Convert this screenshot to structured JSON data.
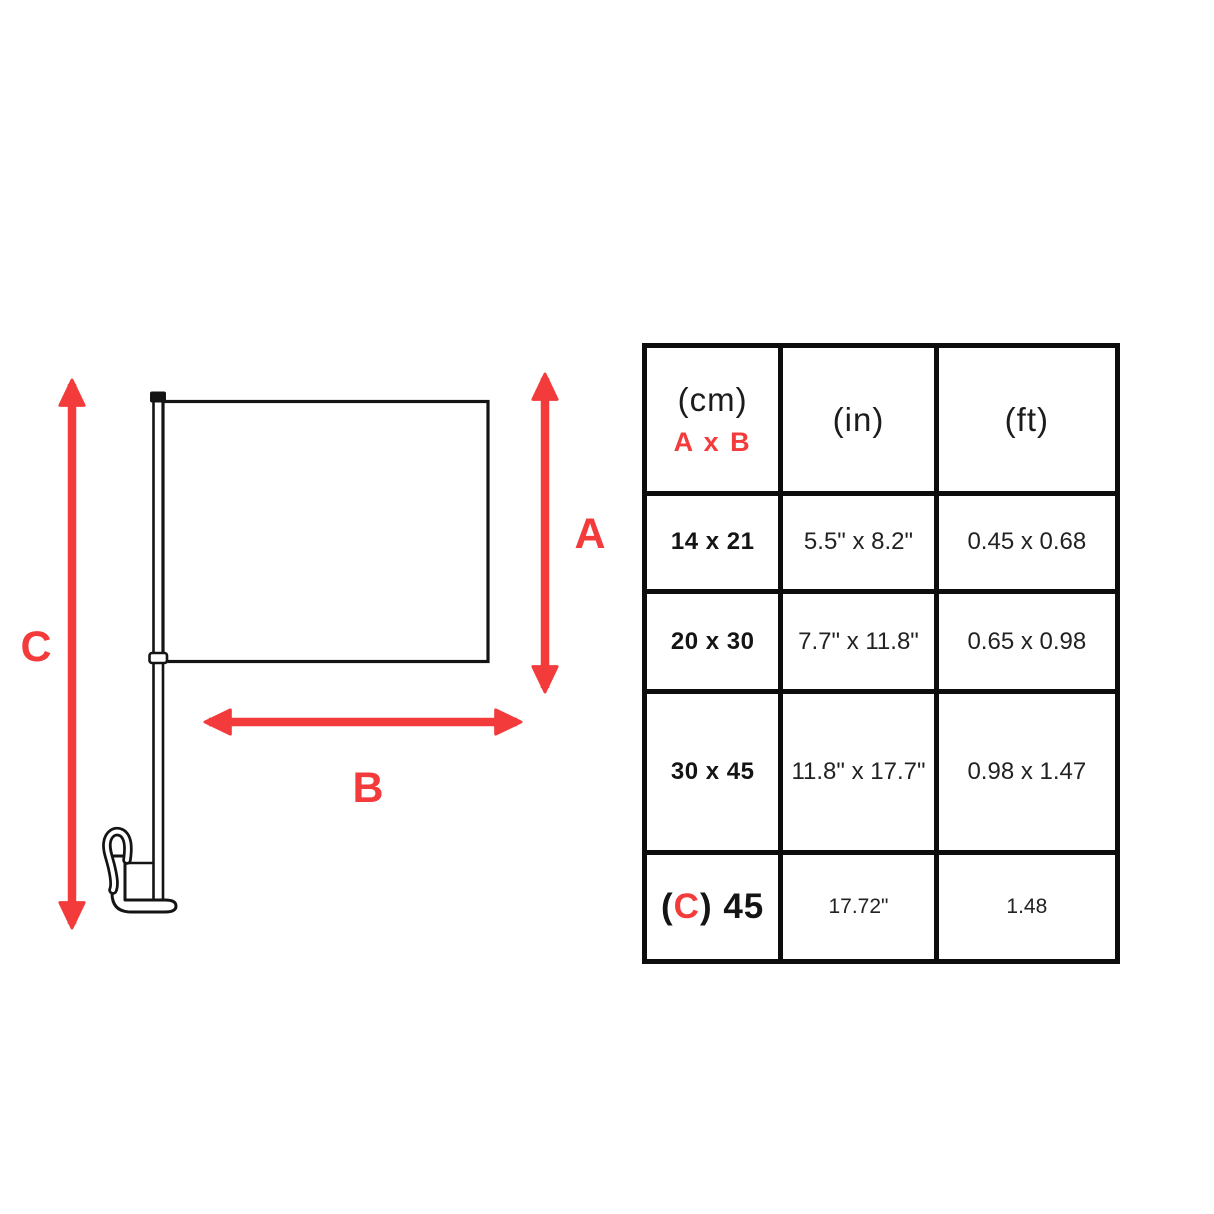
{
  "diagram": {
    "labels": {
      "a": "A",
      "b": "B",
      "c": "C"
    },
    "accent_color": "#f33b3b",
    "parts": [
      "flag",
      "pole",
      "pole-cap",
      "pole-collar",
      "window-clip-hook",
      "clip-base"
    ]
  },
  "table": {
    "header": {
      "cm": "(cm)",
      "cm_sub": "A x B",
      "in": "(in)",
      "ft": "(ft)"
    },
    "rows": [
      {
        "cm": "14 x 21",
        "in": "5.5\" x 8.2\"",
        "ft": "0.45 x 0.68"
      },
      {
        "cm": "20 x 30",
        "in": "7.7\" x 11.8\"",
        "ft": "0.65 x 0.98"
      },
      {
        "cm": "30 x 45",
        "in": "11.8\" x 17.7\"",
        "ft": "0.98 x 1.47"
      },
      {
        "cm_paren_open": "(",
        "cm_c": "C",
        "cm_rest": ") 45",
        "in": "17.72\"",
        "ft": "1.48"
      }
    ]
  }
}
